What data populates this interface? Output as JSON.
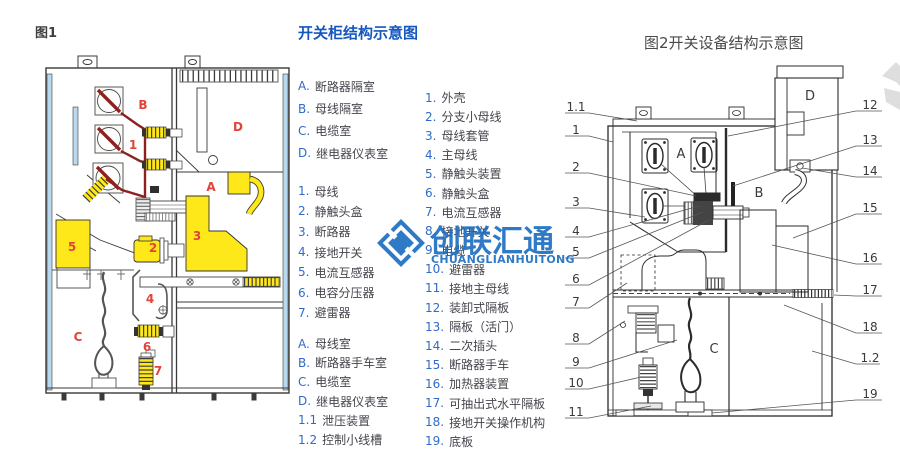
{
  "figure1": {
    "caption": "图1",
    "part_labels": [
      "A",
      "B",
      "C",
      "D",
      "1",
      "2",
      "3",
      "4",
      "5",
      "6",
      "7"
    ]
  },
  "legend": {
    "title": "开关柜结构示意图",
    "compartments_fig1": [
      {
        "marker": "A.",
        "text": "断路器隔室"
      },
      {
        "marker": "B.",
        "text": "母线隔室"
      },
      {
        "marker": "C.",
        "text": "电缆室"
      },
      {
        "marker": "D.",
        "text": "继电器仪表室"
      }
    ],
    "parts_fig1": [
      {
        "marker": "1.",
        "text": "母线"
      },
      {
        "marker": "2.",
        "text": "静触头盒"
      },
      {
        "marker": "3.",
        "text": "断路器"
      },
      {
        "marker": "4.",
        "text": "接地开关"
      },
      {
        "marker": "5.",
        "text": "电流互感器"
      },
      {
        "marker": "6.",
        "text": "电容分压器"
      },
      {
        "marker": "7.",
        "text": "避雷器"
      }
    ],
    "compartments_fig2": [
      {
        "marker": "A.",
        "text": "母线室"
      },
      {
        "marker": "B.",
        "text": "断路器手车室"
      },
      {
        "marker": "C.",
        "text": "电缆室"
      },
      {
        "marker": "D.",
        "text": "继电器仪表室"
      },
      {
        "marker": "1.1",
        "text": "泄压装置"
      },
      {
        "marker": "1.2",
        "text": "控制小线槽"
      }
    ],
    "parts_fig2": [
      {
        "marker": "1.",
        "text": "外壳"
      },
      {
        "marker": "2.",
        "text": "分支小母线"
      },
      {
        "marker": "3.",
        "text": "母线套管"
      },
      {
        "marker": "4.",
        "text": "主母线"
      },
      {
        "marker": "5.",
        "text": "静触头装置"
      },
      {
        "marker": "6.",
        "text": "静触头盒"
      },
      {
        "marker": "7.",
        "text": "电流互感器"
      },
      {
        "marker": "8.",
        "text": "接地开关"
      },
      {
        "marker": "9.",
        "text": "电缆"
      },
      {
        "marker": "10.",
        "text": "避雷器"
      },
      {
        "marker": "11.",
        "text": "接地主母线"
      },
      {
        "marker": "12.",
        "text": "装卸式隔板"
      },
      {
        "marker": "13.",
        "text": "隔板（活门）"
      },
      {
        "marker": "14.",
        "text": "二次插头"
      },
      {
        "marker": "15.",
        "text": "断路器手车"
      },
      {
        "marker": "16.",
        "text": "加热器装置"
      },
      {
        "marker": "17.",
        "text": "可抽出式水平隔板"
      },
      {
        "marker": "18.",
        "text": "接地开关操作机构"
      },
      {
        "marker": "19.",
        "text": "底板"
      }
    ]
  },
  "figure2": {
    "caption": "图2开关设备结构示意图",
    "compartment_labels": [
      "A",
      "B",
      "C",
      "D"
    ],
    "callouts_left": [
      "1.1",
      "1",
      "2",
      "3",
      "4",
      "5",
      "6",
      "7",
      "8",
      "9",
      "10",
      "11"
    ],
    "callouts_right": [
      "12",
      "13",
      "14",
      "15",
      "16",
      "17",
      "18",
      "1.2",
      "19"
    ]
  },
  "watermark": {
    "name": "创联汇通",
    "latin": "CHUANGLIANHUITONG"
  },
  "colors": {
    "legend_title_blue": "#1557be",
    "legend_marker_blue": "#2f6bc8",
    "figure1_label_red": "#e2433a",
    "busbar_dark_red": "#8e2020",
    "component_yellow": "#ffe81a",
    "panel_light_blue": "#b8d9ef",
    "watermark_blue": "#1e6fc2"
  }
}
